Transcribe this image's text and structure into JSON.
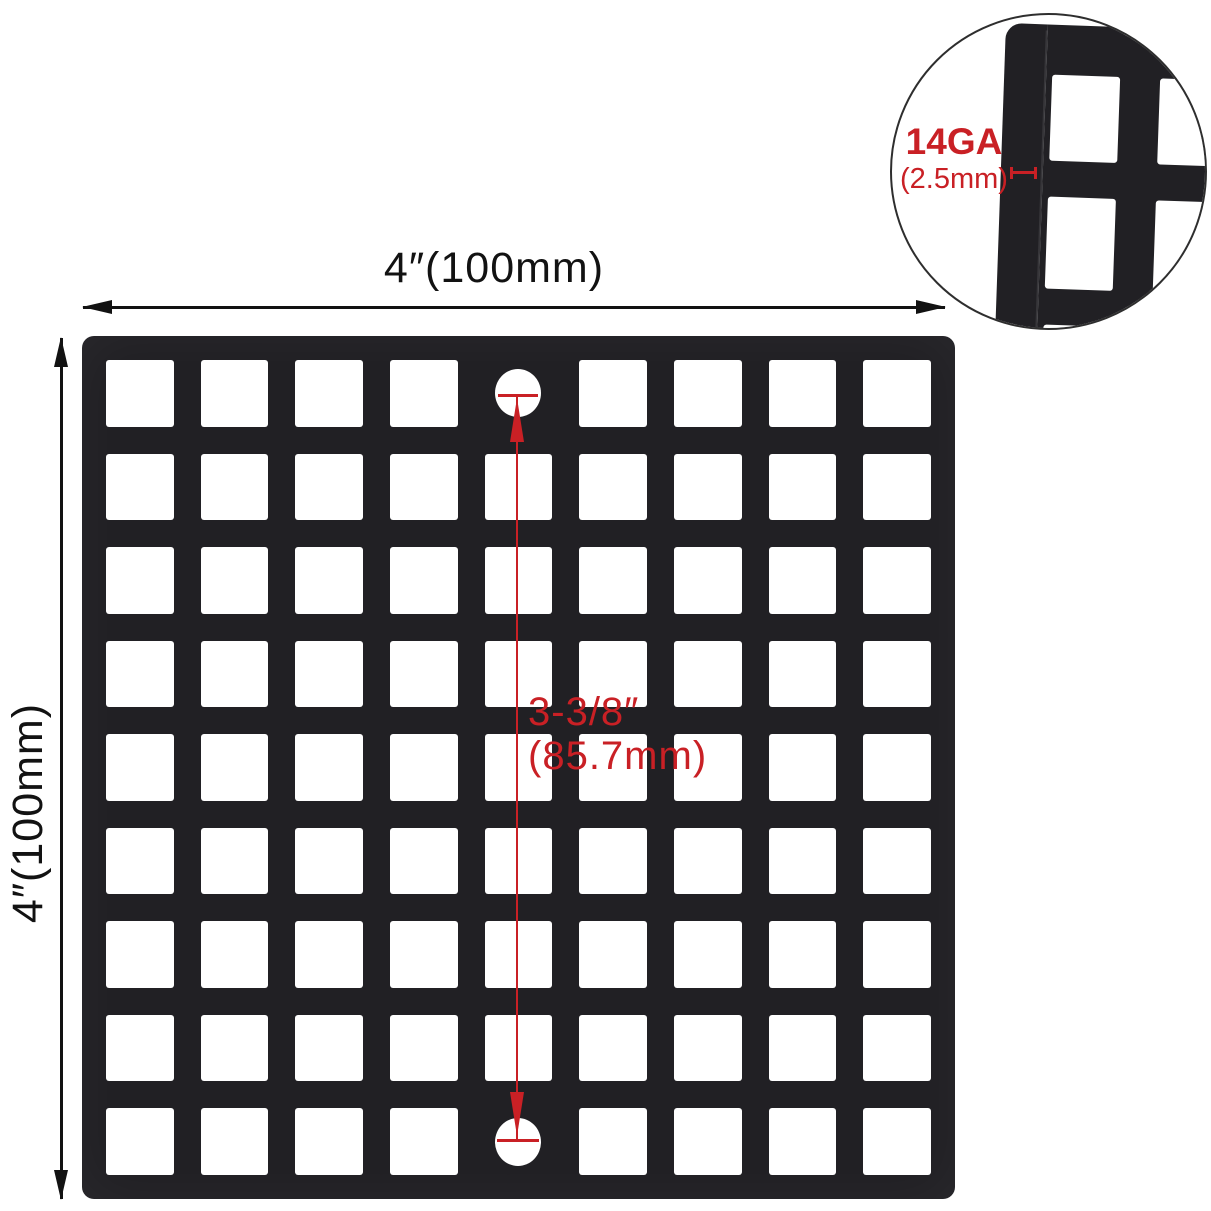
{
  "title": "Square drain grate dimension diagram",
  "dimensions": {
    "width_label": "4″(100mm)",
    "height_label": "4″(100mm)",
    "hole_spacing": {
      "line1": "3-3/8″",
      "line2": "(85.7mm)"
    }
  },
  "inset": {
    "gauge_label": "14GA",
    "thickness_label": "(2.5mm)"
  },
  "grate": {
    "rows": 9,
    "cols": 9,
    "screw_hole_cells": [
      [
        0,
        4
      ],
      [
        8,
        4
      ]
    ],
    "closeup_grid": {
      "rows": 3,
      "cols": 2
    }
  },
  "colors": {
    "ink": "#121212",
    "red": "#c92025",
    "grate": "#212024",
    "background": "#ffffff"
  }
}
